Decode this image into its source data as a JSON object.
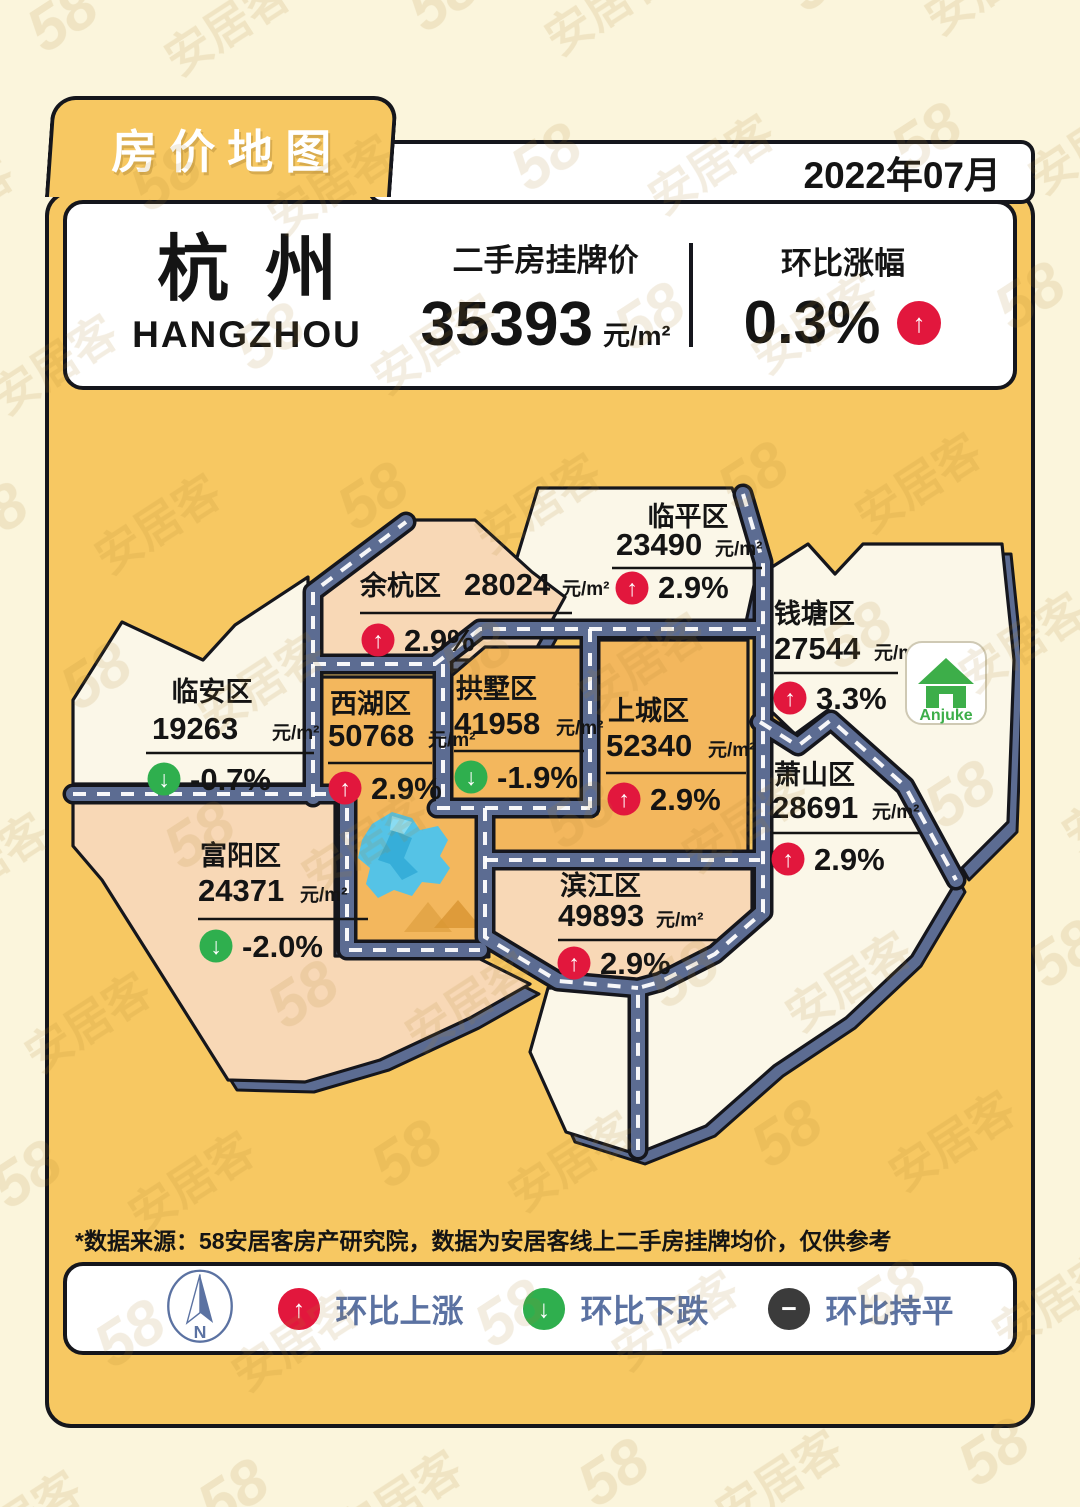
{
  "header": {
    "tab_title": "房价地图",
    "date": "2022年07月"
  },
  "summary": {
    "city": "杭州",
    "city_en": "HANGZHOU",
    "listing_label": "二手房挂牌价",
    "listing_price": "35393",
    "listing_unit": "元/m²",
    "mom_label": "环比涨幅",
    "mom_value": "0.3%",
    "mom_arrow": "↑",
    "mom_badge_color": "#E2173D"
  },
  "map": {
    "districts": [
      {
        "id": "linping",
        "name": "临平区",
        "price": "23490",
        "unit": "元/m²",
        "change": "2.9%",
        "direction": "up",
        "arrow": "↑",
        "badge_color": "#E2173D",
        "fill": "#FBF7E8"
      },
      {
        "id": "yuhang",
        "name": "余杭区",
        "price": "28024",
        "unit": "元/m²",
        "change": "2.9%",
        "direction": "up",
        "arrow": "↑",
        "badge_color": "#E2173D",
        "fill": "#F8D8B6"
      },
      {
        "id": "qiantang",
        "name": "钱塘区",
        "price": "27544",
        "unit": "元/m²",
        "change": "3.3%",
        "direction": "up",
        "arrow": "↑",
        "badge_color": "#E2173D",
        "fill": "#FBF7E8"
      },
      {
        "id": "linan",
        "name": "临安区",
        "price": "19263",
        "unit": "元/m²",
        "change": "-0.7%",
        "direction": "down",
        "arrow": "↓",
        "badge_color": "#2FAF4E",
        "fill": "#FBF7E8"
      },
      {
        "id": "xihu",
        "name": "西湖区",
        "price": "50768",
        "unit": "元/m²",
        "change": "2.9%",
        "direction": "up",
        "arrow": "↑",
        "badge_color": "#E2173D",
        "fill": "#F3B75D"
      },
      {
        "id": "gongshu",
        "name": "拱墅区",
        "price": "41958",
        "unit": "元/m²",
        "change": "-1.9%",
        "direction": "down",
        "arrow": "↓",
        "badge_color": "#2FAF4E",
        "fill": "#F3B75D"
      },
      {
        "id": "shangcheng",
        "name": "上城区",
        "price": "52340",
        "unit": "元/m²",
        "change": "2.9%",
        "direction": "up",
        "arrow": "↑",
        "badge_color": "#E2173D",
        "fill": "#F3B75D"
      },
      {
        "id": "xiaoshan",
        "name": "萧山区",
        "price": "28691",
        "unit": "元/m²",
        "change": "2.9%",
        "direction": "up",
        "arrow": "↑",
        "badge_color": "#E2173D",
        "fill": "#FBF7E8"
      },
      {
        "id": "fuyang",
        "name": "富阳区",
        "price": "24371",
        "unit": "元/m²",
        "change": "-2.0%",
        "direction": "down",
        "arrow": "↓",
        "badge_color": "#2FAF4E",
        "fill": "#F8D8B6"
      },
      {
        "id": "binjiang",
        "name": "滨江区",
        "price": "49893",
        "unit": "元/m²",
        "change": "2.9%",
        "direction": "up",
        "arrow": "↑",
        "badge_color": "#E2173D",
        "fill": "#F8D8B6"
      }
    ],
    "logo_text": "Anjuke",
    "road_color": "#5C6C92",
    "lake_color": "#55C3E6"
  },
  "footer": {
    "note": "*数据来源：58安居客房产研究院，数据为安居客线上二手房挂牌均价，仅供参考"
  },
  "legend": {
    "compass_label": "N",
    "items": [
      {
        "label": "环比上涨",
        "arrow": "↑",
        "color": "#E2173D"
      },
      {
        "label": "环比下跌",
        "arrow": "↓",
        "color": "#2FAF4E"
      },
      {
        "label": "环比持平",
        "arrow": "−",
        "color": "#3B3B3B"
      }
    ]
  },
  "watermark": {
    "brand_number": "58",
    "brand_name": "安居客"
  }
}
